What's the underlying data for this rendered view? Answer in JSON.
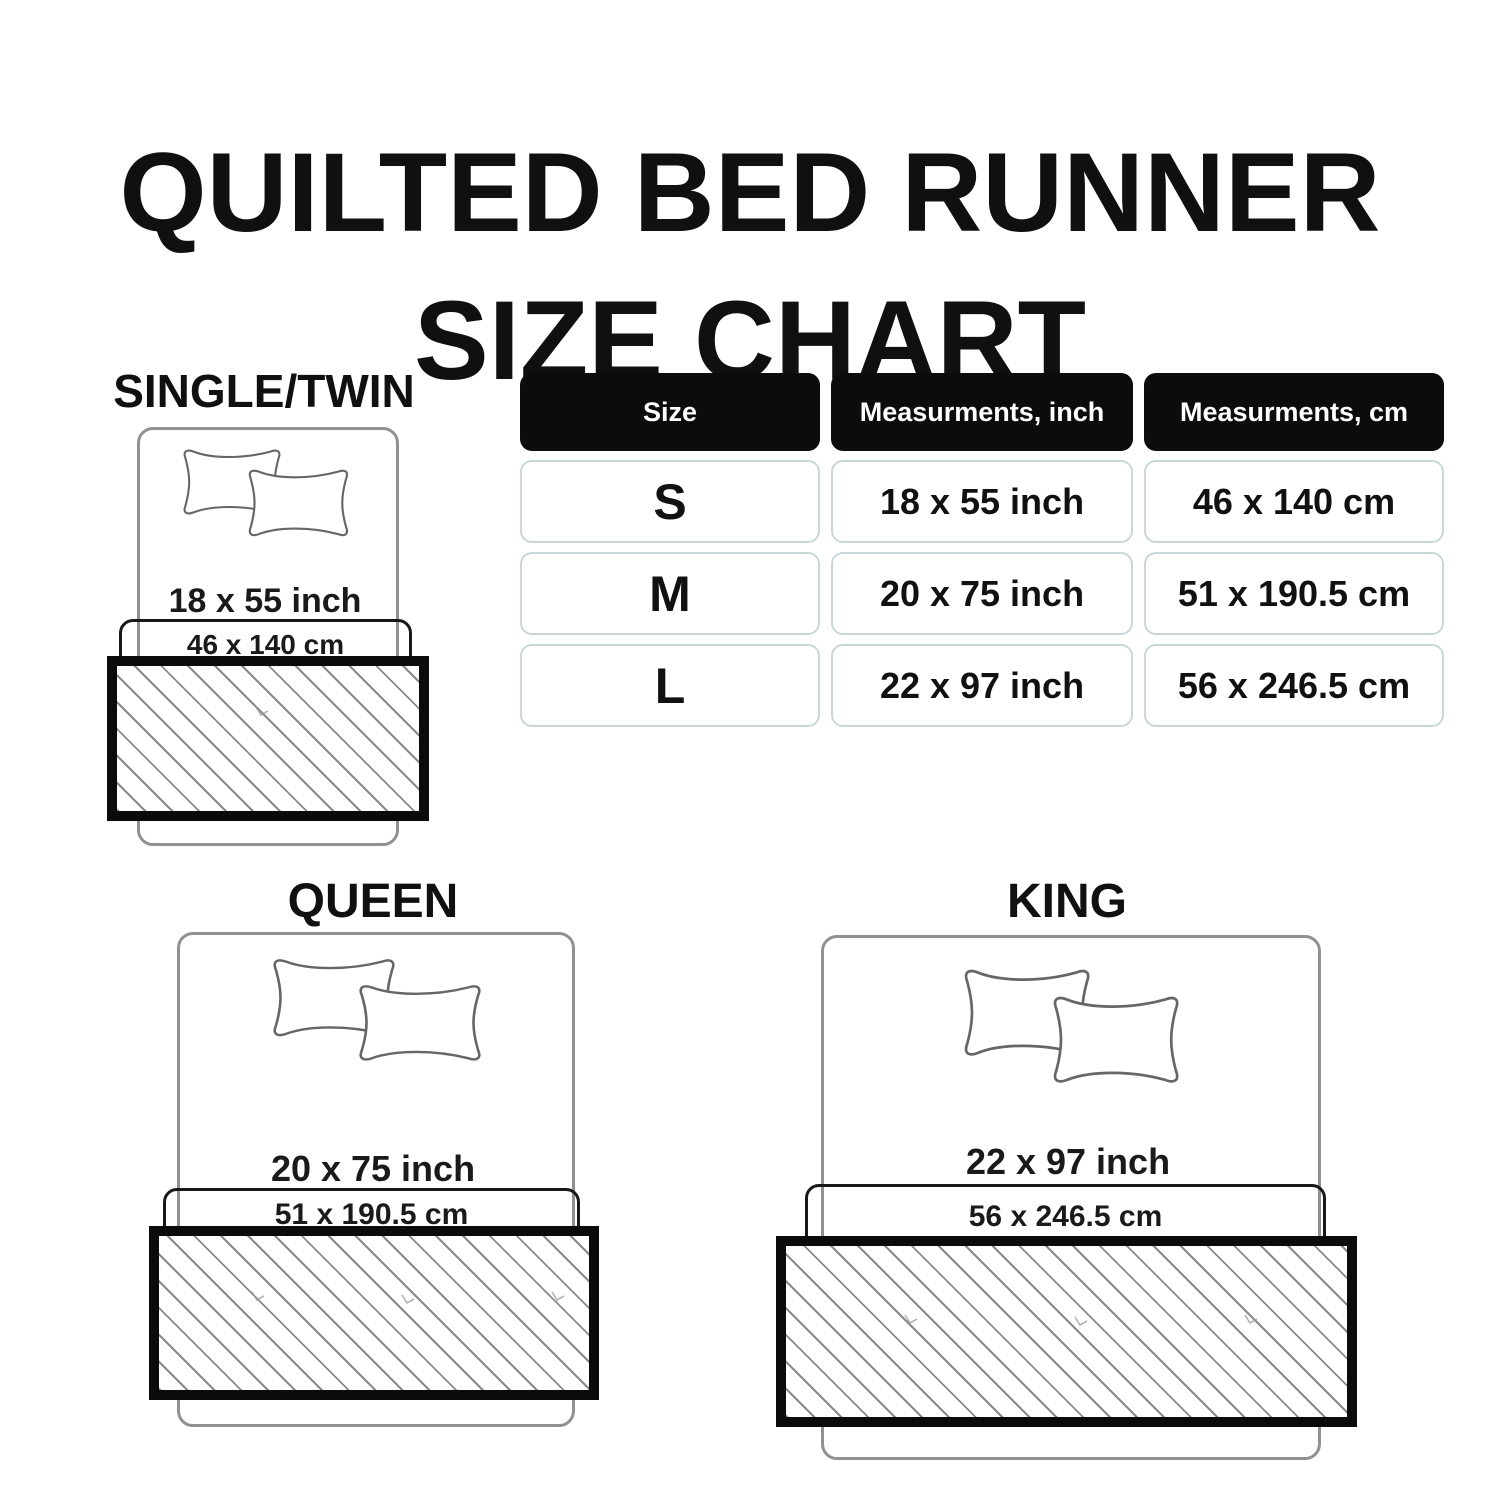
{
  "title": {
    "line1": "QUILTED BED RUNNER",
    "line2": "SIZE CHART"
  },
  "table": {
    "headers": {
      "size": "Size",
      "inch": "Measurments, inch",
      "cm": "Measurments, cm"
    },
    "rows": [
      {
        "size": "S",
        "inch": "18 x 55 inch",
        "cm": "46 x 140 cm"
      },
      {
        "size": "M",
        "inch": "20 x 75 inch",
        "cm": "51 x 190.5 cm"
      },
      {
        "size": "L",
        "inch": "22 x 97 inch",
        "cm": "56 x 246.5 cm"
      }
    ]
  },
  "diagrams": [
    {
      "label": "SINGLE/TWIN",
      "inch": "18 x 55 inch",
      "cm": "46 x 140 cm"
    },
    {
      "label": "QUEEN",
      "inch": "20 x 75 inch",
      "cm": "51 x 190.5 cm"
    },
    {
      "label": "KING",
      "inch": "22 x 97 inch",
      "cm": "56 x 246.5 cm"
    }
  ],
  "colors": {
    "text": "#151515",
    "header_bg": "#0c0c0c",
    "header_text": "#ffffff",
    "cell_border": "#c9d6da",
    "bed_outline": "#919191",
    "pillow_outline": "#666666",
    "runner_border": "#0b0b0b",
    "hatch_line": "#8a8a8a"
  }
}
